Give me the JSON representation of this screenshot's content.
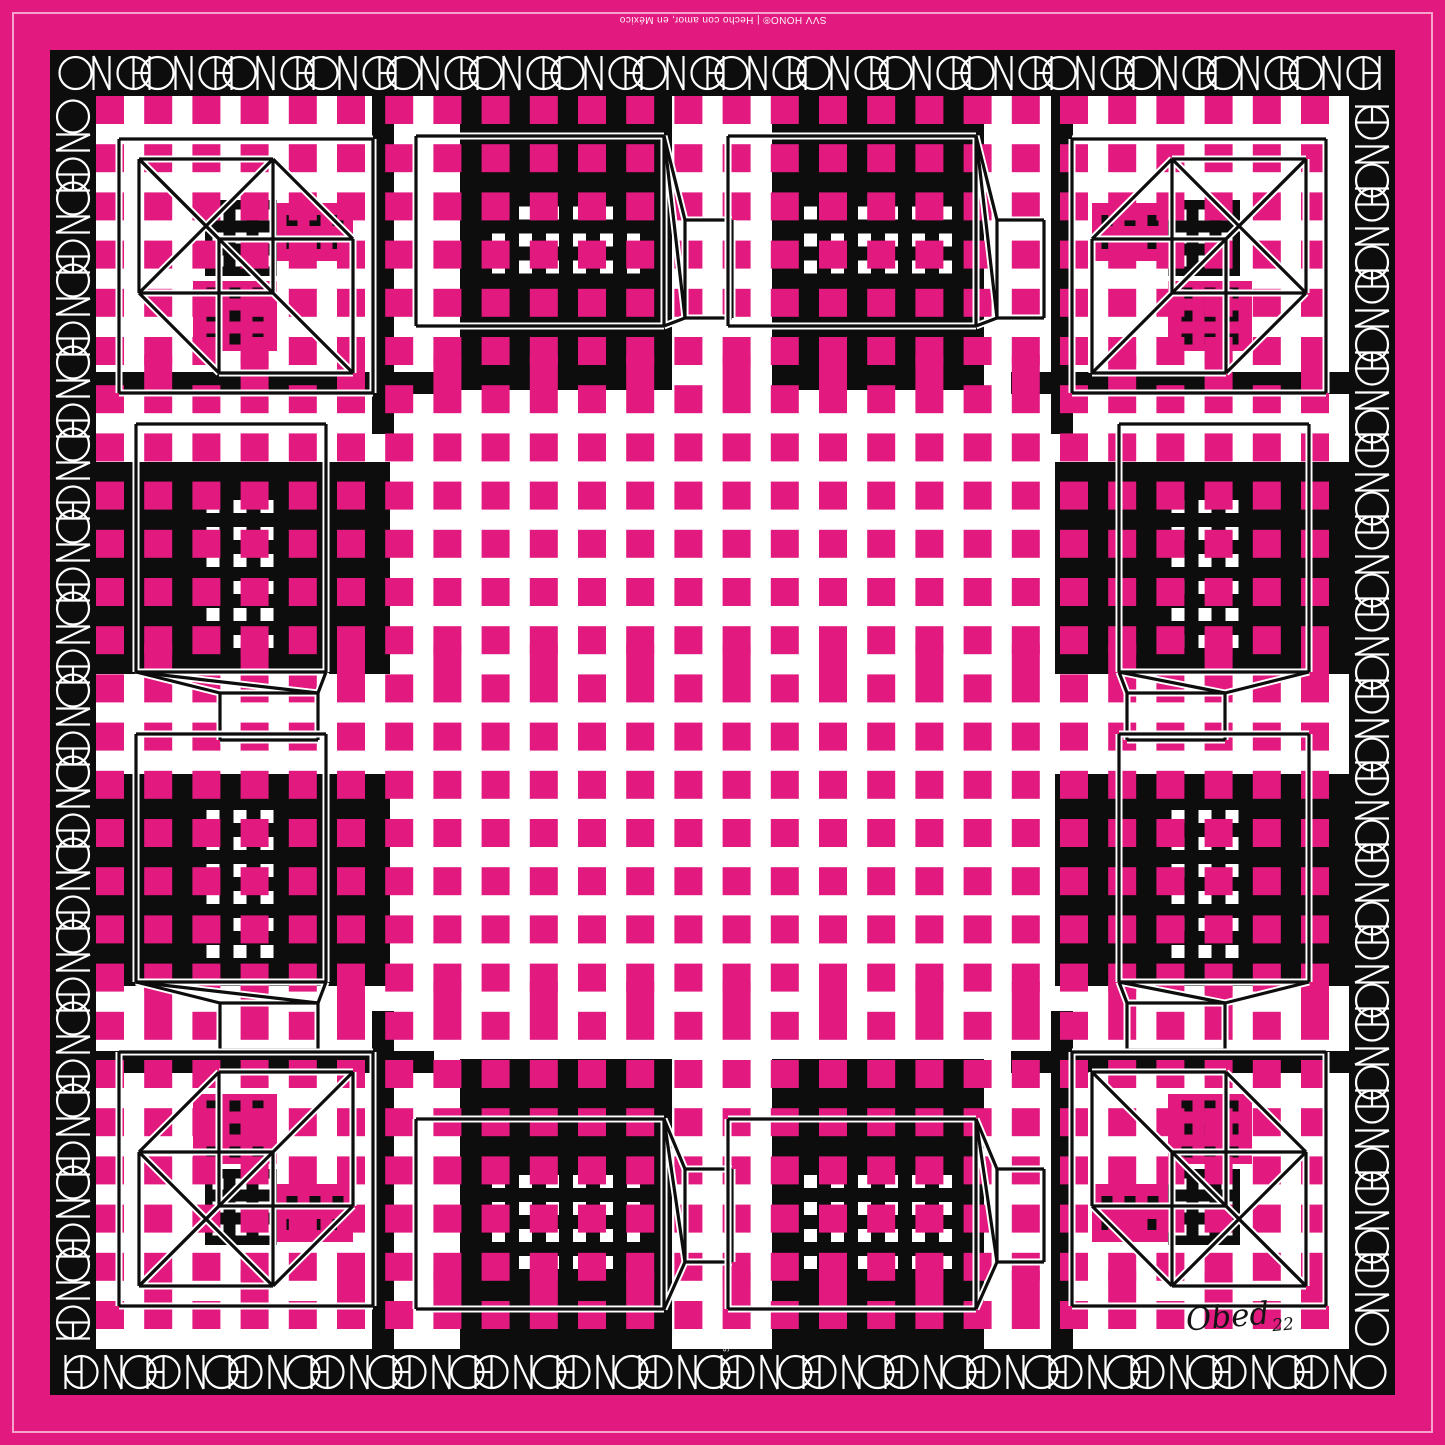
{
  "artwork": {
    "type_label": "geometric textile scarf print",
    "brand": "HONO",
    "border_logo_text": "HONO",
    "top_caption": "SVV HONO® | Hecho con amor, en México",
    "border_mark": "SVV",
    "signature_name": "Obed",
    "signature_year": "22"
  },
  "pattern": {
    "size": 1445,
    "colors": {
      "pink": "#E2197F",
      "black": "#0D0D0D",
      "white": "#FFFFFF"
    },
    "frame": {
      "pinstripe_inset": 13,
      "band_outer": 50,
      "band_inner": 96
    },
    "logo": {
      "glyph_w": 96,
      "glyph_h": 40,
      "stroke": 2.2,
      "period": 82,
      "top": {
        "count": 16,
        "rotate": 180
      },
      "bottom": {
        "count": 16,
        "rotate": 0
      },
      "left": {
        "count": 15,
        "rotate": -90
      },
      "right": {
        "count": 15,
        "rotate": 90
      }
    },
    "grid": {
      "start": 110,
      "pitch": 48.2,
      "count": 26,
      "square": 28,
      "tall_rows": [
        6,
        12,
        19,
        25
      ],
      "tall_h": 58
    },
    "slabs": [
      [
        460,
        96,
        212,
        294
      ],
      [
        772,
        96,
        212,
        294
      ],
      [
        460,
        1059,
        212,
        290
      ],
      [
        772,
        1059,
        212,
        290
      ],
      [
        96,
        462,
        294,
        212
      ],
      [
        96,
        774,
        294,
        212
      ],
      [
        1055,
        462,
        294,
        212
      ],
      [
        1055,
        774,
        294,
        212
      ]
    ],
    "strips": [
      [
        372,
        96,
        22,
        338
      ],
      [
        96,
        372,
        338,
        22
      ],
      [
        1051,
        96,
        22,
        338
      ],
      [
        1011,
        372,
        338,
        22
      ],
      [
        372,
        1011,
        22,
        338
      ],
      [
        96,
        1051,
        338,
        22
      ],
      [
        1051,
        1011,
        22,
        338
      ],
      [
        1011,
        1051,
        338,
        22
      ]
    ],
    "windows": [
      {
        "cx": 566,
        "cy": 240,
        "cols": 6,
        "rows": 3
      },
      {
        "cx": 878,
        "cy": 240,
        "cols": 6,
        "rows": 3
      },
      {
        "cx": 566,
        "cy": 1222,
        "cols": 6,
        "rows": 4
      },
      {
        "cx": 878,
        "cy": 1222,
        "cols": 6,
        "rows": 4
      },
      {
        "cx": 240,
        "cy": 574,
        "cols": 3,
        "rows": 6
      },
      {
        "cx": 240,
        "cy": 884,
        "cols": 3,
        "rows": 6
      },
      {
        "cx": 1205,
        "cy": 574,
        "cols": 3,
        "rows": 6
      },
      {
        "cx": 1205,
        "cy": 884,
        "cols": 3,
        "rows": 6
      }
    ],
    "window_dot": {
      "size": 13,
      "pitch": 27
    },
    "corner_blocks": [
      {
        "x": 205,
        "y": 200,
        "w": 72,
        "h": 76,
        "fill": "black",
        "cols": 3,
        "rows": 3
      },
      {
        "x": 277,
        "y": 203,
        "w": 76,
        "h": 58,
        "fill": "pink",
        "cols": 3,
        "rows": 2
      },
      {
        "x": 193,
        "y": 281,
        "w": 84,
        "h": 70,
        "fill": "pink",
        "cols": 3,
        "rows": 3
      },
      {
        "x": 1168,
        "y": 200,
        "w": 72,
        "h": 76,
        "fill": "black",
        "cols": 3,
        "rows": 3
      },
      {
        "x": 1092,
        "y": 203,
        "w": 76,
        "h": 58,
        "fill": "pink",
        "cols": 3,
        "rows": 2
      },
      {
        "x": 1168,
        "y": 281,
        "w": 84,
        "h": 70,
        "fill": "pink",
        "cols": 3,
        "rows": 3
      },
      {
        "x": 205,
        "y": 1169,
        "w": 72,
        "h": 76,
        "fill": "black",
        "cols": 3,
        "rows": 3
      },
      {
        "x": 277,
        "y": 1184,
        "w": 76,
        "h": 58,
        "fill": "pink",
        "cols": 3,
        "rows": 2
      },
      {
        "x": 193,
        "y": 1094,
        "w": 84,
        "h": 70,
        "fill": "pink",
        "cols": 3,
        "rows": 3
      },
      {
        "x": 1168,
        "y": 1169,
        "w": 72,
        "h": 76,
        "fill": "black",
        "cols": 3,
        "rows": 3
      },
      {
        "x": 1092,
        "y": 1184,
        "w": 76,
        "h": 58,
        "fill": "pink",
        "cols": 3,
        "rows": 2
      },
      {
        "x": 1168,
        "y": 1094,
        "w": 84,
        "h": 70,
        "fill": "pink",
        "cols": 3,
        "rows": 3
      }
    ],
    "corner_dot": {
      "size": 11,
      "pitch": 23
    },
    "wireframes": [
      {
        "front": [
          416,
          136,
          248,
          190
        ],
        "back": [
          685,
          220,
          47,
          98
        ],
        "connect": [
          "tr-tl",
          "br-bl"
        ],
        "diag": [
          "tr-bl"
        ]
      },
      {
        "front": [
          728,
          136,
          248,
          190
        ],
        "back": [
          997,
          220,
          47,
          98
        ],
        "connect": [
          "tr-tl",
          "br-bl"
        ],
        "diag": [
          "tr-bl"
        ]
      },
      {
        "front": [
          416,
          1119,
          248,
          190
        ],
        "back": [
          685,
          1169,
          47,
          93
        ],
        "connect": [
          "tr-tl",
          "br-bl"
        ],
        "diag": [
          "tr-bl"
        ]
      },
      {
        "front": [
          728,
          1119,
          248,
          190
        ],
        "back": [
          997,
          1169,
          47,
          93
        ],
        "connect": [
          "tr-tl",
          "br-bl"
        ],
        "diag": [
          "tr-bl"
        ]
      },
      {
        "front": [
          136,
          424,
          190,
          248
        ],
        "back": [
          220,
          693,
          98,
          47
        ],
        "connect": [
          "bl-tl",
          "br-tr"
        ],
        "diag": [
          "bl-tr"
        ]
      },
      {
        "front": [
          136,
          734,
          190,
          248
        ],
        "back": [
          220,
          1003,
          98,
          47
        ],
        "connect": [
          "bl-tl",
          "br-tr"
        ],
        "diag": [
          "bl-tr"
        ]
      },
      {
        "front": [
          1119,
          424,
          190,
          248
        ],
        "back": [
          1127,
          693,
          98,
          47
        ],
        "connect": [
          "bl-tl",
          "br-tr"
        ],
        "diag": [
          "bl-tr"
        ]
      },
      {
        "front": [
          1119,
          734,
          190,
          248
        ],
        "back": [
          1127,
          1003,
          98,
          47
        ],
        "connect": [
          "bl-tl",
          "br-tr"
        ],
        "diag": [
          "bl-tr"
        ]
      },
      {
        "outer": [
          119,
          139,
          254,
          254
        ],
        "front": [
          139,
          159,
          134,
          134
        ],
        "back": [
          219,
          239,
          134,
          134
        ],
        "connect": [
          "tl-tl",
          "tr-tr",
          "bl-bl",
          "br-br"
        ],
        "cross": true
      },
      {
        "outer": [
          1072,
          139,
          254,
          254
        ],
        "front": [
          1172,
          159,
          134,
          134
        ],
        "back": [
          1092,
          239,
          134,
          134
        ],
        "connect": [
          "tl-tl",
          "tr-tr",
          "bl-bl",
          "br-br"
        ],
        "cross": true
      },
      {
        "outer": [
          119,
          1052,
          254,
          254
        ],
        "front": [
          139,
          1152,
          134,
          134
        ],
        "back": [
          219,
          1072,
          134,
          134
        ],
        "connect": [
          "tl-tl",
          "tr-tr",
          "bl-bl",
          "br-br"
        ],
        "cross": true
      },
      {
        "outer": [
          1072,
          1052,
          254,
          254
        ],
        "front": [
          1172,
          1152,
          134,
          134
        ],
        "back": [
          1092,
          1072,
          134,
          134
        ],
        "connect": [
          "tl-tl",
          "tr-tr",
          "bl-bl",
          "br-br"
        ],
        "cross": true
      }
    ],
    "wire_stroke": {
      "casing": 7,
      "ink": 3.2
    }
  }
}
